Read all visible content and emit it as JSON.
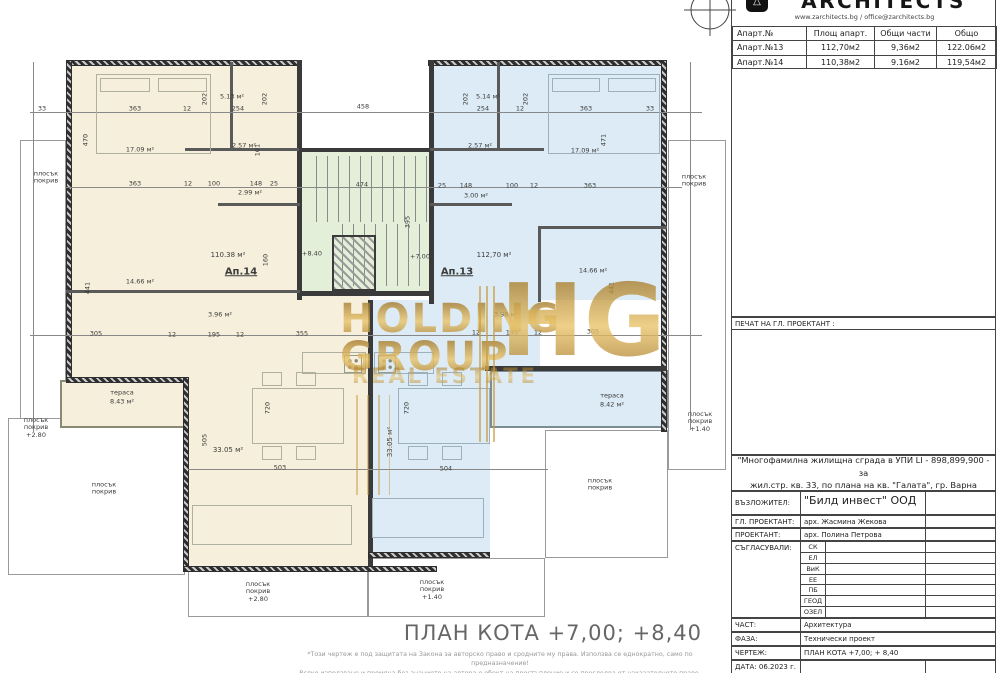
{
  "title_block": {
    "logo_text": "ARCHITECTS",
    "website": "www.zarchitects.bg  /  office@zarchitects.bg",
    "apartments_table": {
      "headers": [
        "Апарт.№",
        "Площ апарт.",
        "Общи части",
        "Общо"
      ],
      "rows": [
        [
          "Апарт.№13",
          "112,70м2",
          "9,36м2",
          "122.06м2"
        ],
        [
          "Апарт.№14",
          "110,38м2",
          "9.16м2",
          "119,54м2"
        ]
      ]
    },
    "stamp_label": "ПЕЧАТ НА ГЛ. ПРОЕКТАНТ :",
    "project_title_line1": "\"Многофамилна жилищна сграда в УПИ LI - 898,899,900 - за",
    "project_title_line2": "жил.стр. кв. 33, по плана на кв. \"Галата\", гр. Варна",
    "fields": {
      "client_label": "ВЪЗЛОЖИТЕЛ:",
      "client_value": "\"Билд инвест\" ООД",
      "chief_label": "ГЛ. ПРОЕКТАНТ:",
      "chief_value": "арх. Жасмина Жекова",
      "designer_label": "ПРОЕКТАНТ:",
      "designer_value": "арх. Полина Петрова",
      "approvals_label": "СЪГЛАСУВАЛИ:",
      "part_label": "ЧАСТ:",
      "part_value": "Архитектура",
      "phase_label": "ФАЗА:",
      "phase_value": "Технически проект",
      "drawing_label": "ЧЕРТЕЖ:",
      "drawing_value": "ПЛАН КОТА  +7,00; + 8,40",
      "date_label": "ДАТА: 06.2023 г."
    },
    "approval_codes": [
      "СК",
      "ЕЛ",
      "ВиК",
      "ЕЕ",
      "ПБ",
      "ГЕОД",
      "ОЗЕЛ"
    ]
  },
  "footer": {
    "title": "ПЛАН КОТА  +7,00; +8,40",
    "copyright_line1": "*Този чертеж е под защитата на Закона за авторско право и сродните му права. Използва се еднократно, само по предназначение!",
    "copyright_line2": "Всяко използване и промяна без знанието на автора е обект на престъпление и се преследва от наказателното право."
  },
  "watermark": {
    "line1": "HOLDING",
    "line2": "GROUP",
    "monogram": "HG",
    "line3": "REAL ESTATE",
    "color": "#c8922c"
  },
  "plan": {
    "apartment_left_label": "Ап.14",
    "apartment_right_label": "Ап.13",
    "colors": {
      "left_fill": "#f6efdb",
      "right_fill": "#dcebf5",
      "stair_fill": "#e4efda",
      "wall": "#3a3a3a"
    },
    "annotations": [
      {
        "t": "17.09 м²",
        "x": 140,
        "y": 150
      },
      {
        "t": "5.13 м²",
        "x": 232,
        "y": 97
      },
      {
        "t": "2.57 м²",
        "x": 244,
        "y": 146
      },
      {
        "t": "2.99 м²",
        "x": 250,
        "y": 193
      },
      {
        "t": "110.38 м²",
        "x": 228,
        "y": 255,
        "s": 7
      },
      {
        "t": "Ап.14",
        "x": 241,
        "y": 272,
        "s": 10,
        "b": 1,
        "u": 1
      },
      {
        "t": "3.96 м²",
        "x": 220,
        "y": 315
      },
      {
        "t": "14.66 м²",
        "x": 140,
        "y": 282
      },
      {
        "t": "33.05 м²",
        "x": 228,
        "y": 450,
        "s": 7
      },
      {
        "t": "тераса",
        "x": 122,
        "y": 393
      },
      {
        "t": "8.43 м²",
        "x": 122,
        "y": 402
      },
      {
        "t": "5.14 м²",
        "x": 488,
        "y": 97
      },
      {
        "t": "2.57 м²",
        "x": 480,
        "y": 146
      },
      {
        "t": "3.00 м²",
        "x": 476,
        "y": 196
      },
      {
        "t": "17.09 м²",
        "x": 585,
        "y": 151
      },
      {
        "t": "112,70 м²",
        "x": 494,
        "y": 255,
        "s": 7
      },
      {
        "t": "Ап.13",
        "x": 457,
        "y": 272,
        "s": 10,
        "b": 1,
        "u": 1
      },
      {
        "t": "3.96 м²",
        "x": 506,
        "y": 315
      },
      {
        "t": "14.66 м²",
        "x": 593,
        "y": 271
      },
      {
        "t": "33.05 м²",
        "x": 390,
        "y": 442,
        "r": -90,
        "s": 7
      },
      {
        "t": "тераса",
        "x": 612,
        "y": 396
      },
      {
        "t": "8.42 м²",
        "x": 612,
        "y": 405
      },
      {
        "t": "плосък\nпокрив",
        "x": 46,
        "y": 178
      },
      {
        "t": "плосък\nпокрив\n+2.80",
        "x": 36,
        "y": 428
      },
      {
        "t": "плосък\nпокрив",
        "x": 104,
        "y": 489
      },
      {
        "t": "плосък\nпокрив\n+2.80",
        "x": 258,
        "y": 592
      },
      {
        "t": "плосък\nпокрив\n+1.40",
        "x": 432,
        "y": 590
      },
      {
        "t": "плосък\nпокрив",
        "x": 694,
        "y": 181
      },
      {
        "t": "плосък\nпокрив\n+1.40",
        "x": 700,
        "y": 422
      },
      {
        "t": "плосък\nпокрив",
        "x": 600,
        "y": 485
      },
      {
        "t": "363",
        "x": 135,
        "y": 109
      },
      {
        "t": "12",
        "x": 187,
        "y": 109
      },
      {
        "t": "254",
        "x": 238,
        "y": 109
      },
      {
        "t": "458",
        "x": 363,
        "y": 107
      },
      {
        "t": "254",
        "x": 483,
        "y": 109
      },
      {
        "t": "12",
        "x": 520,
        "y": 109
      },
      {
        "t": "363",
        "x": 586,
        "y": 109
      },
      {
        "t": "33",
        "x": 42,
        "y": 109
      },
      {
        "t": "33",
        "x": 650,
        "y": 109
      },
      {
        "t": "202",
        "x": 205,
        "y": 99,
        "r": -90
      },
      {
        "t": "202",
        "x": 265,
        "y": 99,
        "r": -90
      },
      {
        "t": "202",
        "x": 466,
        "y": 99,
        "r": -90
      },
      {
        "t": "202",
        "x": 526,
        "y": 99,
        "r": -90
      },
      {
        "t": "470",
        "x": 86,
        "y": 140,
        "r": -90
      },
      {
        "t": "471",
        "x": 604,
        "y": 140,
        "r": -90
      },
      {
        "t": "441",
        "x": 88,
        "y": 288,
        "r": -90
      },
      {
        "t": "441",
        "x": 612,
        "y": 288,
        "r": -90
      },
      {
        "t": "101",
        "x": 258,
        "y": 150,
        "r": -90
      },
      {
        "t": "363",
        "x": 135,
        "y": 184
      },
      {
        "t": "12",
        "x": 188,
        "y": 184
      },
      {
        "t": "100",
        "x": 214,
        "y": 184
      },
      {
        "t": "148",
        "x": 256,
        "y": 184
      },
      {
        "t": "25",
        "x": 274,
        "y": 184
      },
      {
        "t": "25",
        "x": 442,
        "y": 186
      },
      {
        "t": "148",
        "x": 466,
        "y": 186
      },
      {
        "t": "100",
        "x": 512,
        "y": 186
      },
      {
        "t": "12",
        "x": 534,
        "y": 186
      },
      {
        "t": "363",
        "x": 590,
        "y": 186
      },
      {
        "t": "474",
        "x": 362,
        "y": 185
      },
      {
        "t": "395",
        "x": 408,
        "y": 222,
        "r": -90
      },
      {
        "t": "160",
        "x": 266,
        "y": 260,
        "r": -90
      },
      {
        "t": "+8.40",
        "x": 312,
        "y": 254
      },
      {
        "t": "+7.00",
        "x": 420,
        "y": 257
      },
      {
        "t": "305",
        "x": 96,
        "y": 334
      },
      {
        "t": "12",
        "x": 172,
        "y": 335
      },
      {
        "t": "195",
        "x": 214,
        "y": 335
      },
      {
        "t": "12",
        "x": 240,
        "y": 335
      },
      {
        "t": "355",
        "x": 302,
        "y": 334
      },
      {
        "t": "12",
        "x": 476,
        "y": 333
      },
      {
        "t": "195",
        "x": 512,
        "y": 333
      },
      {
        "t": "12",
        "x": 538,
        "y": 333
      },
      {
        "t": "305",
        "x": 593,
        "y": 332
      },
      {
        "t": "503",
        "x": 280,
        "y": 468
      },
      {
        "t": "504",
        "x": 446,
        "y": 469
      },
      {
        "t": "505",
        "x": 205,
        "y": 440,
        "r": -90
      },
      {
        "t": "720",
        "x": 268,
        "y": 408,
        "r": -90
      },
      {
        "t": "720",
        "x": 407,
        "y": 408,
        "r": -90
      }
    ]
  }
}
